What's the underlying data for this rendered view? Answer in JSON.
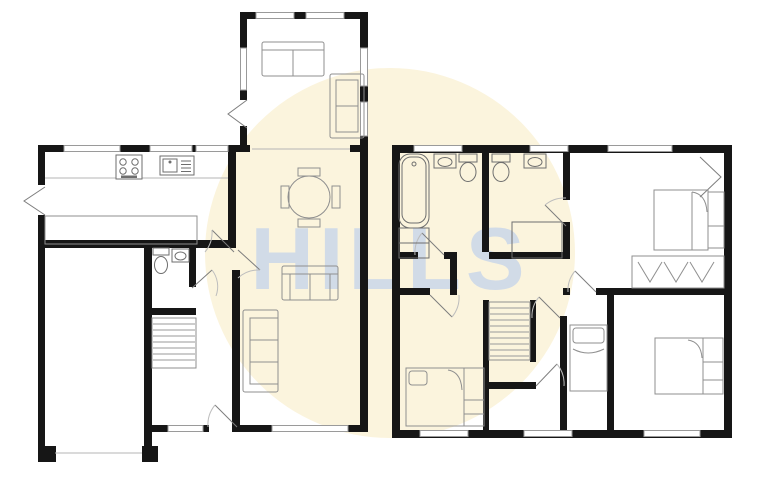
{
  "watermark": {
    "text": "HILLS"
  },
  "colors": {
    "background": "#ffffff",
    "circle": "#fbf4dd",
    "watermark": "#c9d6ea",
    "wall": "#161616",
    "window_line": "#9a9a9a",
    "furniture_line": "#8f8f8f",
    "fixture_line": "#6e6e6e"
  },
  "floorplan": {
    "style": "black-wall architectural floor plan, no room text labels",
    "ground_floor": {
      "rooms": [
        "conservatory",
        "kitchen",
        "dining-area",
        "living-room",
        "wc",
        "hall-with-stairs",
        "garage"
      ],
      "fixtures": [
        "sofa",
        "sofa",
        "round-dining-table",
        "four-chairs",
        "hob",
        "sink-drainer",
        "worktop",
        "island-counter",
        "toilet",
        "basin",
        "staircase",
        "sofa",
        "sofa",
        "garage-door",
        "front-door",
        "windows"
      ]
    },
    "first_floor": {
      "rooms": [
        "bathroom",
        "shower-room",
        "bedroom-1",
        "bedroom-2",
        "bedroom-3",
        "bedroom-4",
        "landing"
      ],
      "fixtures": [
        "bathtub",
        "airing-cupboard",
        "basin",
        "toilet",
        "toilet",
        "basin",
        "shower-tray",
        "double-bed",
        "bedside-unit",
        "wardrobe-with-hanging-clothes",
        "staircase",
        "double-bed",
        "single-bed",
        "double-bed",
        "windows"
      ]
    }
  }
}
